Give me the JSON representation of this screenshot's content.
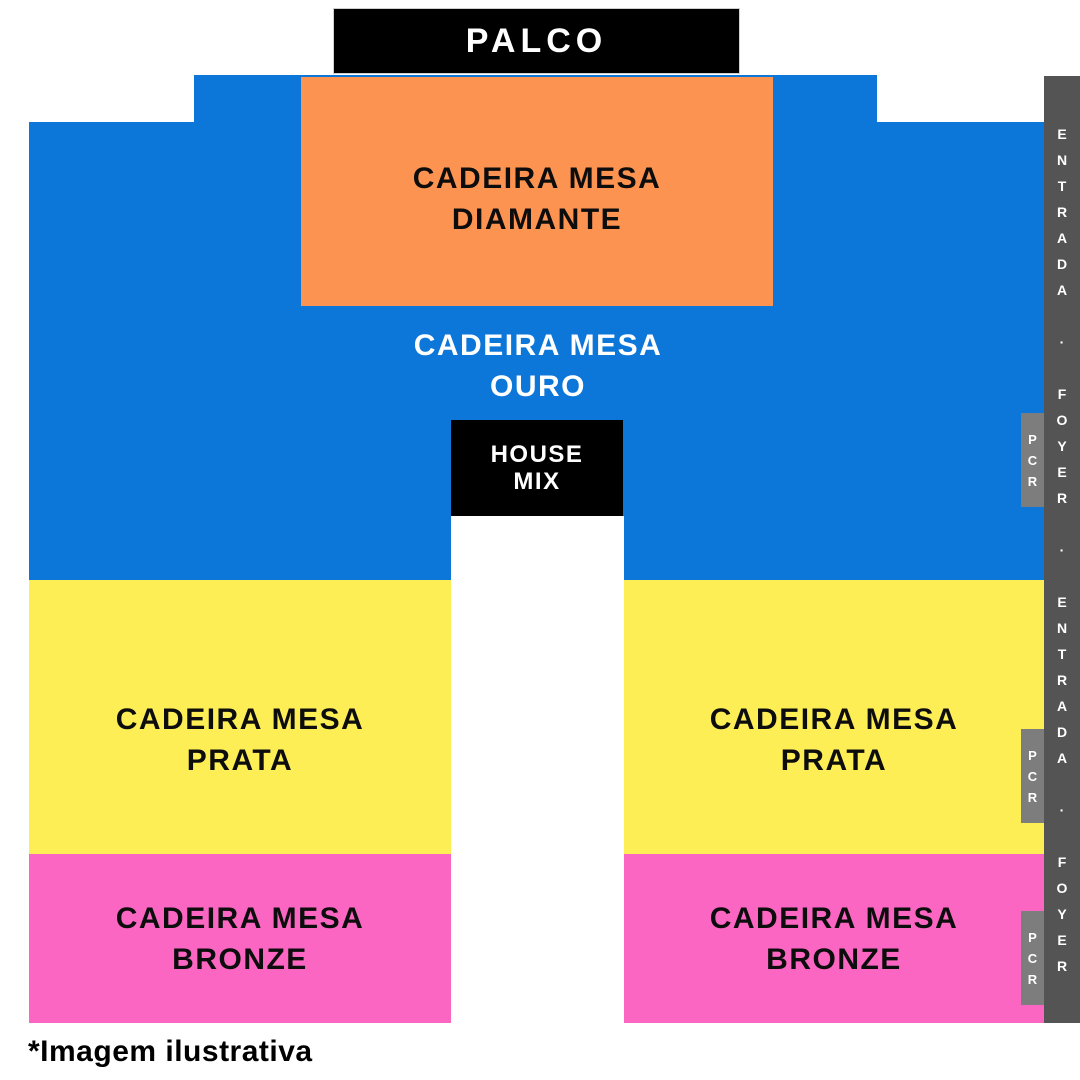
{
  "stage": {
    "label": "PALCO"
  },
  "colors": {
    "blue": "#0d76d9",
    "orange": "#fc9351",
    "yellow": "#fdee55",
    "pink": "#fc66c3",
    "black": "#000000",
    "dark_gray": "#545454",
    "pcr_gray": "#7d7d7d",
    "white": "#ffffff"
  },
  "sections": {
    "diamante": {
      "line1": "CADEIRA MESA",
      "line2": "DIAMANTE"
    },
    "ouro": {
      "line1": "CADEIRA MESA",
      "line2": "OURO"
    },
    "prata_left": {
      "line1": "CADEIRA MESA",
      "line2": "PRATA"
    },
    "prata_right": {
      "line1": "CADEIRA MESA",
      "line2": "PRATA"
    },
    "bronze_left": {
      "line1": "CADEIRA MESA",
      "line2": "BRONZE"
    },
    "bronze_right": {
      "line1": "CADEIRA MESA",
      "line2": "BRONZE"
    }
  },
  "house_mix": {
    "line1": "HOUSE",
    "line2": "MIX"
  },
  "entrance_bar": {
    "text": "ENTRADA · FOYER · ENTRADA · FOYER"
  },
  "pcr_labels": [
    "PCR",
    "PCR",
    "PCR"
  ],
  "footnote": "*Imagem ilustrativa"
}
